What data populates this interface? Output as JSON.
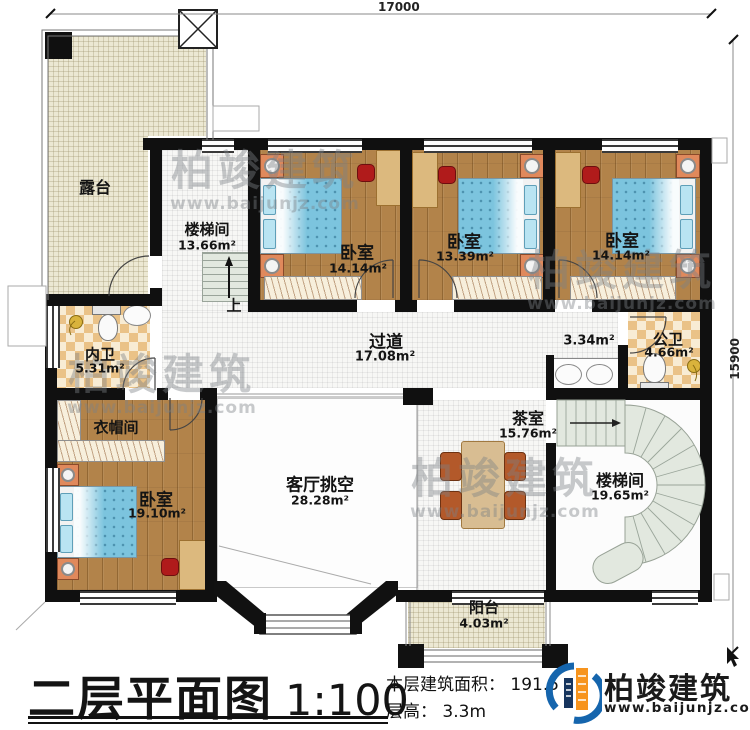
{
  "plan": {
    "dim_top": "17000",
    "dim_right": "15900",
    "up_label": "上",
    "rooms": {
      "terrace": {
        "name": "露台"
      },
      "stair_hall_upper": {
        "name": "楼梯间",
        "area": "13.66m²"
      },
      "bedroom1": {
        "name": "卧室",
        "area": "14.14m²"
      },
      "bedroom2": {
        "name": "卧室",
        "area": "13.39m²"
      },
      "bedroom3": {
        "name": "卧室",
        "area": "14.14m²"
      },
      "inner_bath": {
        "name": "内卫",
        "area": "5.31m²"
      },
      "corridor": {
        "name": "过道",
        "area": "17.08m²"
      },
      "wash_area": {
        "area": "3.34m²"
      },
      "public_bath": {
        "name": "公卫",
        "area": "4.66m²"
      },
      "cloakroom": {
        "name": "衣帽间"
      },
      "bedroom4": {
        "name": "卧室",
        "area": "19.10m²"
      },
      "living_void": {
        "name": "客厅挑空",
        "area": "28.28m²"
      },
      "tea_room": {
        "name": "茶室",
        "area": "15.76m²"
      },
      "stair_hall_spiral": {
        "name": "楼梯间",
        "area": "19.65m²"
      },
      "balcony": {
        "name": "阳台",
        "area": "4.03m²"
      }
    }
  },
  "titleblock": {
    "title": "二层平面图",
    "scale": "1:100",
    "area_line": "本层建筑面积： 191.5",
    "floor_height_line": "层高： 3.3m"
  },
  "brand": {
    "name": "柏竣建筑",
    "website": "www.baijunjz.com"
  },
  "watermark": {
    "text": "柏竣建筑",
    "website": "www.baijunjz.com"
  },
  "colors": {
    "wall": "#101010",
    "wood_floor": "#b2834a",
    "tile_floor": "#f7f7f5",
    "terrace_floor": "#ece8d3",
    "checker_tan": "#eac287",
    "bed_blue": "#7cc4de",
    "stair_tread": "#e2e8df",
    "brand_blue": "#1565ad",
    "brand_orange": "#f7941d"
  }
}
